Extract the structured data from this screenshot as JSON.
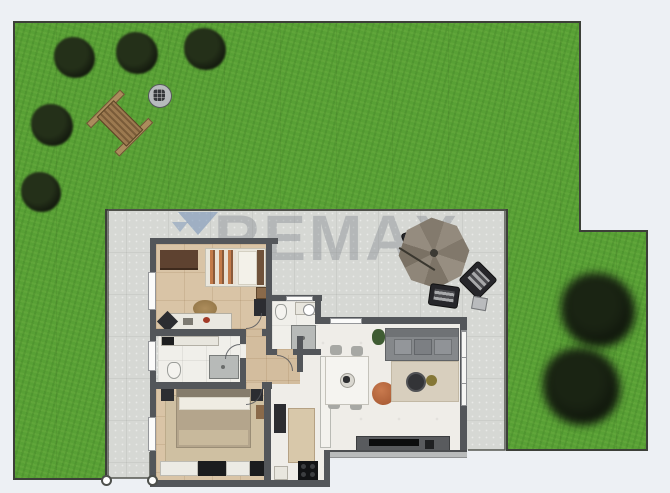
{
  "watermark": {
    "text": "REMAX"
  },
  "colors": {
    "background": "#edf0f4",
    "grass": "#58a035",
    "terrace": "#d6d8d4",
    "plot_border": "#3c3f38",
    "wall": "#53565a",
    "floor_bedroom": "#d9c4a6",
    "floor_wet_room": "#f0efea",
    "floor_living": "#efede8",
    "watermark_text": "rgba(134,139,146,0.42)",
    "watermark_balloon": "rgba(122,148,184,0.6)",
    "pouf_accent": "#b7663f"
  },
  "scene": {
    "type": "top-down 2D floor plan of a house with garden and terrace",
    "garden": {
      "tree_count": 7,
      "items": [
        "picnic-bench",
        "fire-pit"
      ]
    },
    "terrace": {
      "items": [
        "parasol",
        "lounge-chair",
        "lounge-chair",
        "lounge-chair",
        "side-table"
      ]
    },
    "house_rooms": [
      "bedroom",
      "bathroom",
      "second-bathroom",
      "hallway",
      "master-bedroom",
      "kitchen",
      "living-dining-room"
    ]
  }
}
